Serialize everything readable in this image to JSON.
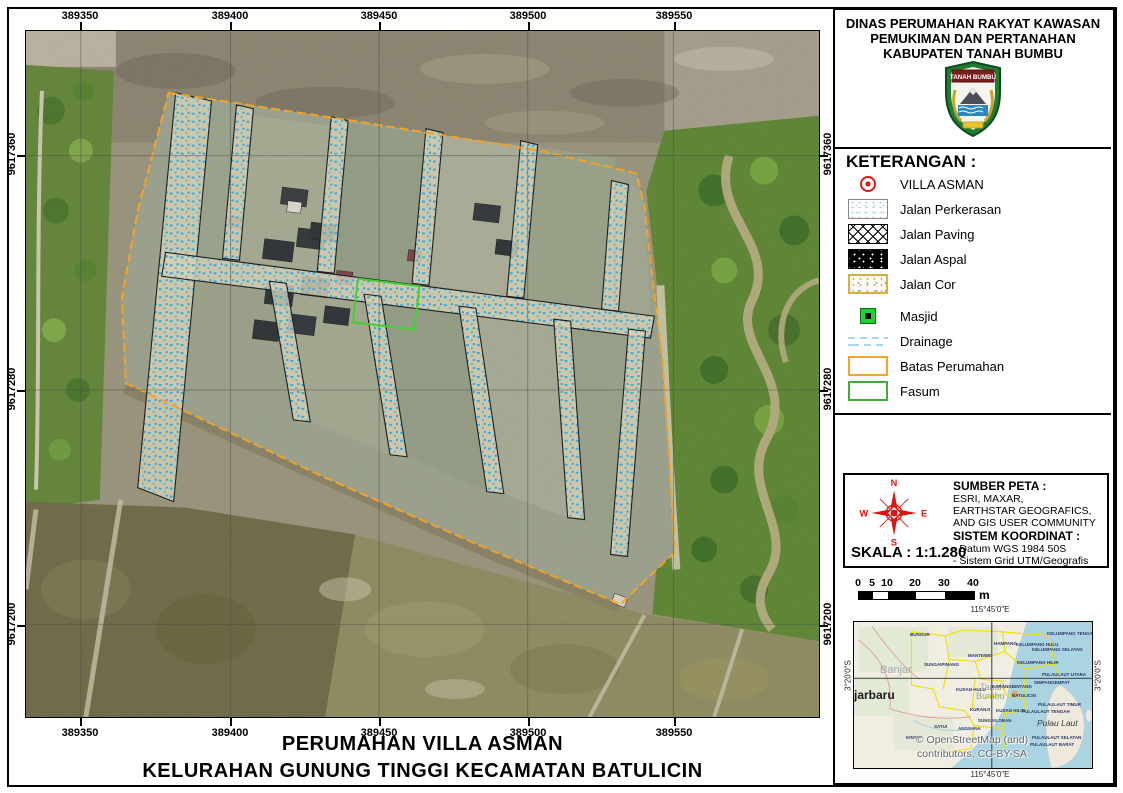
{
  "map": {
    "xticks": [
      {
        "label": "389350",
        "x": 80
      },
      {
        "label": "389400",
        "x": 230
      },
      {
        "label": "389450",
        "x": 379
      },
      {
        "label": "389500",
        "x": 528
      },
      {
        "label": "389550",
        "x": 674
      }
    ],
    "yticks": [
      {
        "label": "9617360",
        "y": 155
      },
      {
        "label": "9617280",
        "y": 390
      },
      {
        "label": "9617200",
        "y": 625
      }
    ],
    "title_line1": "PERUMAHAN VILLA ASMAN",
    "title_line2": "KELURAHAN GUNUNG TINGGI KECAMATAN BATULICIN"
  },
  "panel": {
    "header": {
      "line1": "DINAS PERUMAHAN RAKYAT KAWASAN",
      "line2": "PEMUKIMAN DAN PERTANAHAN",
      "line3": "KABUPATEN TANAH BUMBU",
      "logo_banner": "TANAH BUMBU"
    },
    "legend": {
      "title": "KETERANGAN :",
      "items": [
        {
          "symbol": "point",
          "label": "VILLA ASMAN"
        },
        {
          "symbol": "perkerasan",
          "label": "Jalan Perkerasan"
        },
        {
          "symbol": "paving",
          "label": "Jalan Paving"
        },
        {
          "symbol": "aspal",
          "label": "Jalan Aspal"
        },
        {
          "symbol": "cor",
          "label": "Jalan Cor"
        },
        {
          "symbol": "masjid",
          "label": "Masjid",
          "gap": true
        },
        {
          "symbol": "drainage",
          "label": "Drainage"
        },
        {
          "symbol": "batas",
          "label": "Batas Perumahan"
        },
        {
          "symbol": "fasum",
          "label": "Fasum"
        }
      ]
    },
    "source": {
      "compass": {
        "n": "N",
        "e": "E",
        "s": "S",
        "w": "W"
      },
      "sumber_title": "SUMBER PETA :",
      "sumber_lines": [
        "ESRI, MAXAR,",
        "EARTHSTAR GEOGRAFICS,",
        "AND GIS USER COMMUNITY"
      ],
      "koordinat_title": "SISTEM KOORDINAT :",
      "koordinat_lines": [
        "- Datum WGS 1984 50S",
        "- Sistem Grid UTM/Geografis"
      ],
      "skala": "SKALA : 1:1.280"
    },
    "scalebar": {
      "unit": "m",
      "ticks": [
        {
          "label": "0",
          "x": 0
        },
        {
          "label": "5",
          "x": 14
        },
        {
          "label": "10",
          "x": 29
        },
        {
          "label": "20",
          "x": 57
        },
        {
          "label": "30",
          "x": 86
        },
        {
          "label": "40",
          "x": 115
        }
      ],
      "segments": [
        {
          "x": 0,
          "w": 14,
          "c": "#000000"
        },
        {
          "x": 14,
          "w": 15,
          "c": "#ffffff"
        },
        {
          "x": 29,
          "w": 28,
          "c": "#000000"
        },
        {
          "x": 57,
          "w": 29,
          "c": "#ffffff"
        },
        {
          "x": 86,
          "w": 29,
          "c": "#000000"
        }
      ]
    },
    "inset": {
      "top_label": "115°45'0\"E",
      "bottom_label": "115°45'0\"E",
      "left_label": "3°20'0\"S",
      "right_label": "3°20'0\"S",
      "attribution_line1": "© OpenStreetMap (and)",
      "attribution_line2": "contributors, CC-BY-SA",
      "places": [
        {
          "text": "Banjar",
          "x": 26,
          "y": 42,
          "cls": "pl-lg"
        },
        {
          "text": "jarbaru",
          "x": 0,
          "y": 66,
          "cls": "pl-xl"
        },
        {
          "text": "Tanah",
          "x": 126,
          "y": 60,
          "cls": "pl-md"
        },
        {
          "text": "Bumbu",
          "x": 122,
          "y": 69,
          "cls": "pl-md"
        },
        {
          "text": "Pulau Laut",
          "x": 183,
          "y": 96,
          "cls": "pl-it"
        },
        {
          "text": "BUNGUR",
          "x": 56,
          "y": 10,
          "cls": "pl-sm"
        },
        {
          "text": "HAMPANG",
          "x": 140,
          "y": 19,
          "cls": "pl-sm"
        },
        {
          "text": "KELUMPANG HULU",
          "x": 162,
          "y": 20,
          "cls": "pl-sm"
        },
        {
          "text": "KELUMPANG TENGAH",
          "x": 193,
          "y": 9,
          "cls": "pl-sm"
        },
        {
          "text": "KELUMPANG SELATAN",
          "x": 178,
          "y": 25,
          "cls": "pl-sm"
        },
        {
          "text": "MANTEWE",
          "x": 114,
          "y": 31,
          "cls": "pl-sm"
        },
        {
          "text": "KELUMPANG HILIR",
          "x": 163,
          "y": 38,
          "cls": "pl-sm"
        },
        {
          "text": "SUNGAIPINANG",
          "x": 70,
          "y": 40,
          "cls": "pl-sm"
        },
        {
          "text": "PULAULAUT UTARA",
          "x": 188,
          "y": 50,
          "cls": "pl-sm"
        },
        {
          "text": "SIMPANGEMPAT",
          "x": 180,
          "y": 58,
          "cls": "pl-sm"
        },
        {
          "text": "KARANGBINTANG",
          "x": 138,
          "y": 62,
          "cls": "pl-sm"
        },
        {
          "text": "KUSAN HULU",
          "x": 102,
          "y": 65,
          "cls": "pl-sm"
        },
        {
          "text": "BATULICIN",
          "x": 158,
          "y": 71,
          "cls": "pl-sm"
        },
        {
          "text": "KURANJI",
          "x": 116,
          "y": 85,
          "cls": "pl-sm"
        },
        {
          "text": "KUSAN HILIR",
          "x": 142,
          "y": 86,
          "cls": "pl-sm"
        },
        {
          "text": "PULAULAUT TENGAH",
          "x": 168,
          "y": 87,
          "cls": "pl-sm"
        },
        {
          "text": "PULAULAUT TIMUR",
          "x": 184,
          "y": 80,
          "cls": "pl-sm"
        },
        {
          "text": "SUNGAILOBAN",
          "x": 124,
          "y": 96,
          "cls": "pl-sm"
        },
        {
          "text": "ANGSANA",
          "x": 104,
          "y": 104,
          "cls": "pl-sm"
        },
        {
          "text": "SATUI",
          "x": 80,
          "y": 102,
          "cls": "pl-sm"
        },
        {
          "text": "KINTAP",
          "x": 52,
          "y": 113,
          "cls": "pl-sm"
        },
        {
          "text": "PULAULAUT SELATAN",
          "x": 178,
          "y": 113,
          "cls": "pl-sm"
        },
        {
          "text": "PULAULAUT BARAT",
          "x": 176,
          "y": 120,
          "cls": "pl-sm"
        }
      ]
    }
  },
  "colors": {
    "batas_perumahan": "#F4A426",
    "fasum": "#3FAE3A",
    "masjid": "#1ED32E",
    "drainage": "#A5D9EE",
    "villa_point": "#E01818",
    "road_speckle": "#33B1E2"
  }
}
